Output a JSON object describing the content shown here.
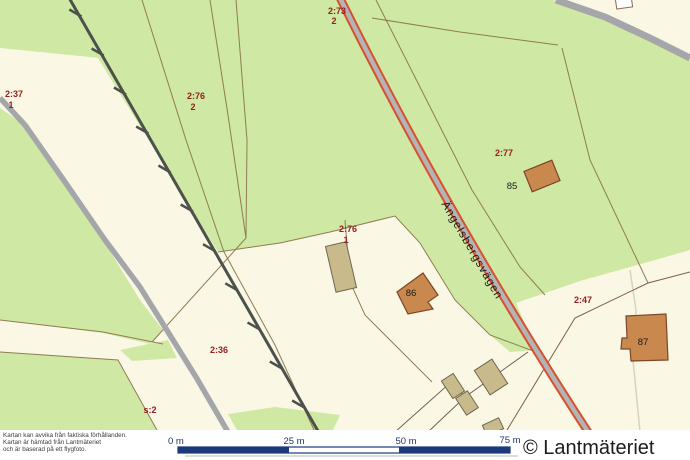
{
  "map": {
    "road_name": "Ängelsbergsvägen",
    "parcels": [
      {
        "id": "2-73",
        "label": "2:73",
        "sub": "2"
      },
      {
        "id": "2-37",
        "label": "2:37",
        "sub": "1"
      },
      {
        "id": "2-76-2",
        "label": "2:76",
        "sub": "2"
      },
      {
        "id": "2-77",
        "label": "2:77",
        "sub": ""
      },
      {
        "id": "2-76-1",
        "label": "2:76",
        "sub": "1"
      },
      {
        "id": "2-36",
        "label": "2:36",
        "sub": ""
      },
      {
        "id": "2-47",
        "label": "2:47",
        "sub": ""
      },
      {
        "id": "s-2",
        "label": "s:2",
        "sub": ""
      }
    ],
    "buildings": [
      {
        "number": "85"
      },
      {
        "number": "86"
      },
      {
        "number": "87"
      }
    ],
    "colors": {
      "open_land": "#fbf7e5",
      "forest": "#cfe8a3",
      "railway": "#4c514c",
      "minor_road": "#a4a6a9",
      "main_road_casing": "#d85030",
      "main_road_fill": "#b3b4b6",
      "parcel_boundary": "#8e7d54",
      "parcel_label": "#932121",
      "building_fill": "#c8884e",
      "outbuilding_fill": "#c9ba8c",
      "scale_bar": "#1b3a7c"
    }
  },
  "footer": {
    "disclaimer": [
      "Kartan kan avvika från faktiska förhållanden.",
      "Kartan är hämtad från Lantmäteriet",
      "och är baserad på ett flygfoto."
    ],
    "scale_labels": [
      "0 m",
      "25 m",
      "50 m",
      "75 m"
    ],
    "copyright": "© Lantmäteriet"
  }
}
